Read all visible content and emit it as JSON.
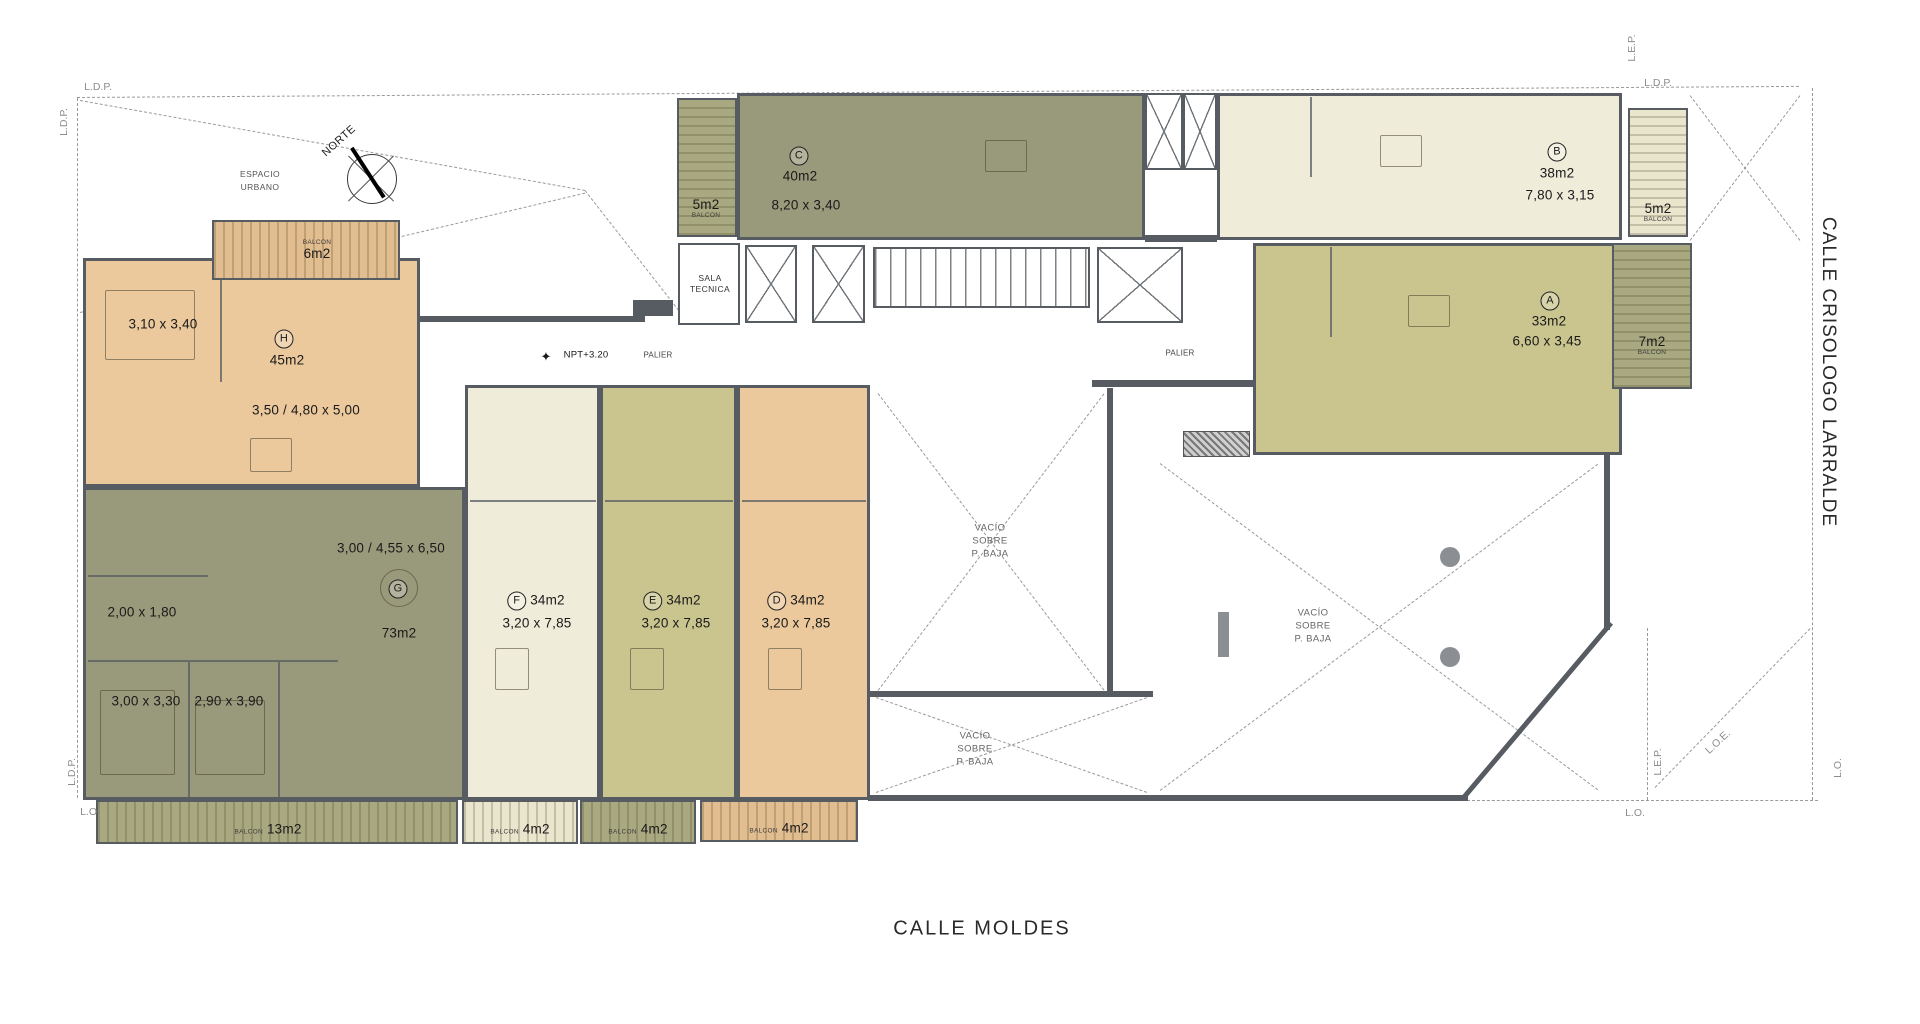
{
  "streets": {
    "bottom": "CALLE MOLDES",
    "right": "CALLE CRISOLOGO LARRALDE"
  },
  "compass_label": "NORTE",
  "site_labels": {
    "espacio_line1": "ESPACIO",
    "espacio_line2": "URBANO",
    "npt": "NPT+3.20",
    "palier_left": "PALIER",
    "palier_right": "PALIER",
    "sala_line1": "SALA",
    "sala_line2": "TECNICA"
  },
  "void_label": {
    "l1": "VACÍO",
    "l2": "SOBRE",
    "l3": "P. BAJA"
  },
  "units": {
    "A": {
      "letter": "A",
      "area": "33m2",
      "dims": "6,60 x 3,45"
    },
    "B": {
      "letter": "B",
      "area": "38m2",
      "dims": "7,80 x 3,15"
    },
    "C": {
      "letter": "C",
      "area": "40m2",
      "dims": "8,20 x 3,40"
    },
    "D": {
      "letter": "D",
      "area": "34m2",
      "dims": "3,20 x 7,85"
    },
    "E": {
      "letter": "E",
      "area": "34m2",
      "dims": "3,20 x 7,85"
    },
    "F": {
      "letter": "F",
      "area": "34m2",
      "dims": "3,20 x 7,85"
    },
    "G": {
      "letter": "G",
      "area": "73m2",
      "dims": "3,00 / 4,55 x 6,50",
      "room1": "2,00 x 1,80",
      "room2": "3,00 x 3,30",
      "room3": "2,90 x 3,90"
    },
    "H": {
      "letter": "H",
      "area": "45m2",
      "dims": "3,50 / 4,80 x 5,00",
      "room1": "3,10 x 3,40"
    }
  },
  "balconies": {
    "h": {
      "tag": "BALCON",
      "area": "6m2"
    },
    "c": {
      "tag": "BALCON",
      "area": "5m2"
    },
    "b": {
      "tag": "BALCON",
      "area": "5m2"
    },
    "a": {
      "tag": "BALCON",
      "area": "7m2"
    },
    "g": {
      "tag": "BALCON",
      "area": "13m2"
    },
    "f": {
      "tag": "BALCON",
      "area": "4m2"
    },
    "e": {
      "tag": "BALCON",
      "area": "4m2"
    },
    "d": {
      "tag": "BALCON",
      "area": "4m2"
    }
  },
  "boundary_labels": {
    "ldp_top": "L.D.P.",
    "ldp_left": "L.D.P.",
    "ldp_bottom_left": "L.D.P.",
    "lo_bottom_left": "L.O.",
    "lep_top_right": "L.E.P.",
    "ldp_top_right": "L.D.P.",
    "lep_bottom_right": "L.E.P.",
    "loe": "L.O.E.",
    "lo_right": "L.O.",
    "lo_bottom_right": "L.O."
  },
  "colors": {
    "wall": "#575c62",
    "unit_tan": "#ebc99d",
    "unit_olive": "#99997c",
    "unit_cream": "#efecda",
    "unit_yellow": "#cac58f",
    "balcony_tan": "#e2bd90",
    "balcony_olive": "#a9a981",
    "balcony_cream": "#eae5cd",
    "boundary": "#9a9a9a",
    "void_text": "#666666"
  }
}
